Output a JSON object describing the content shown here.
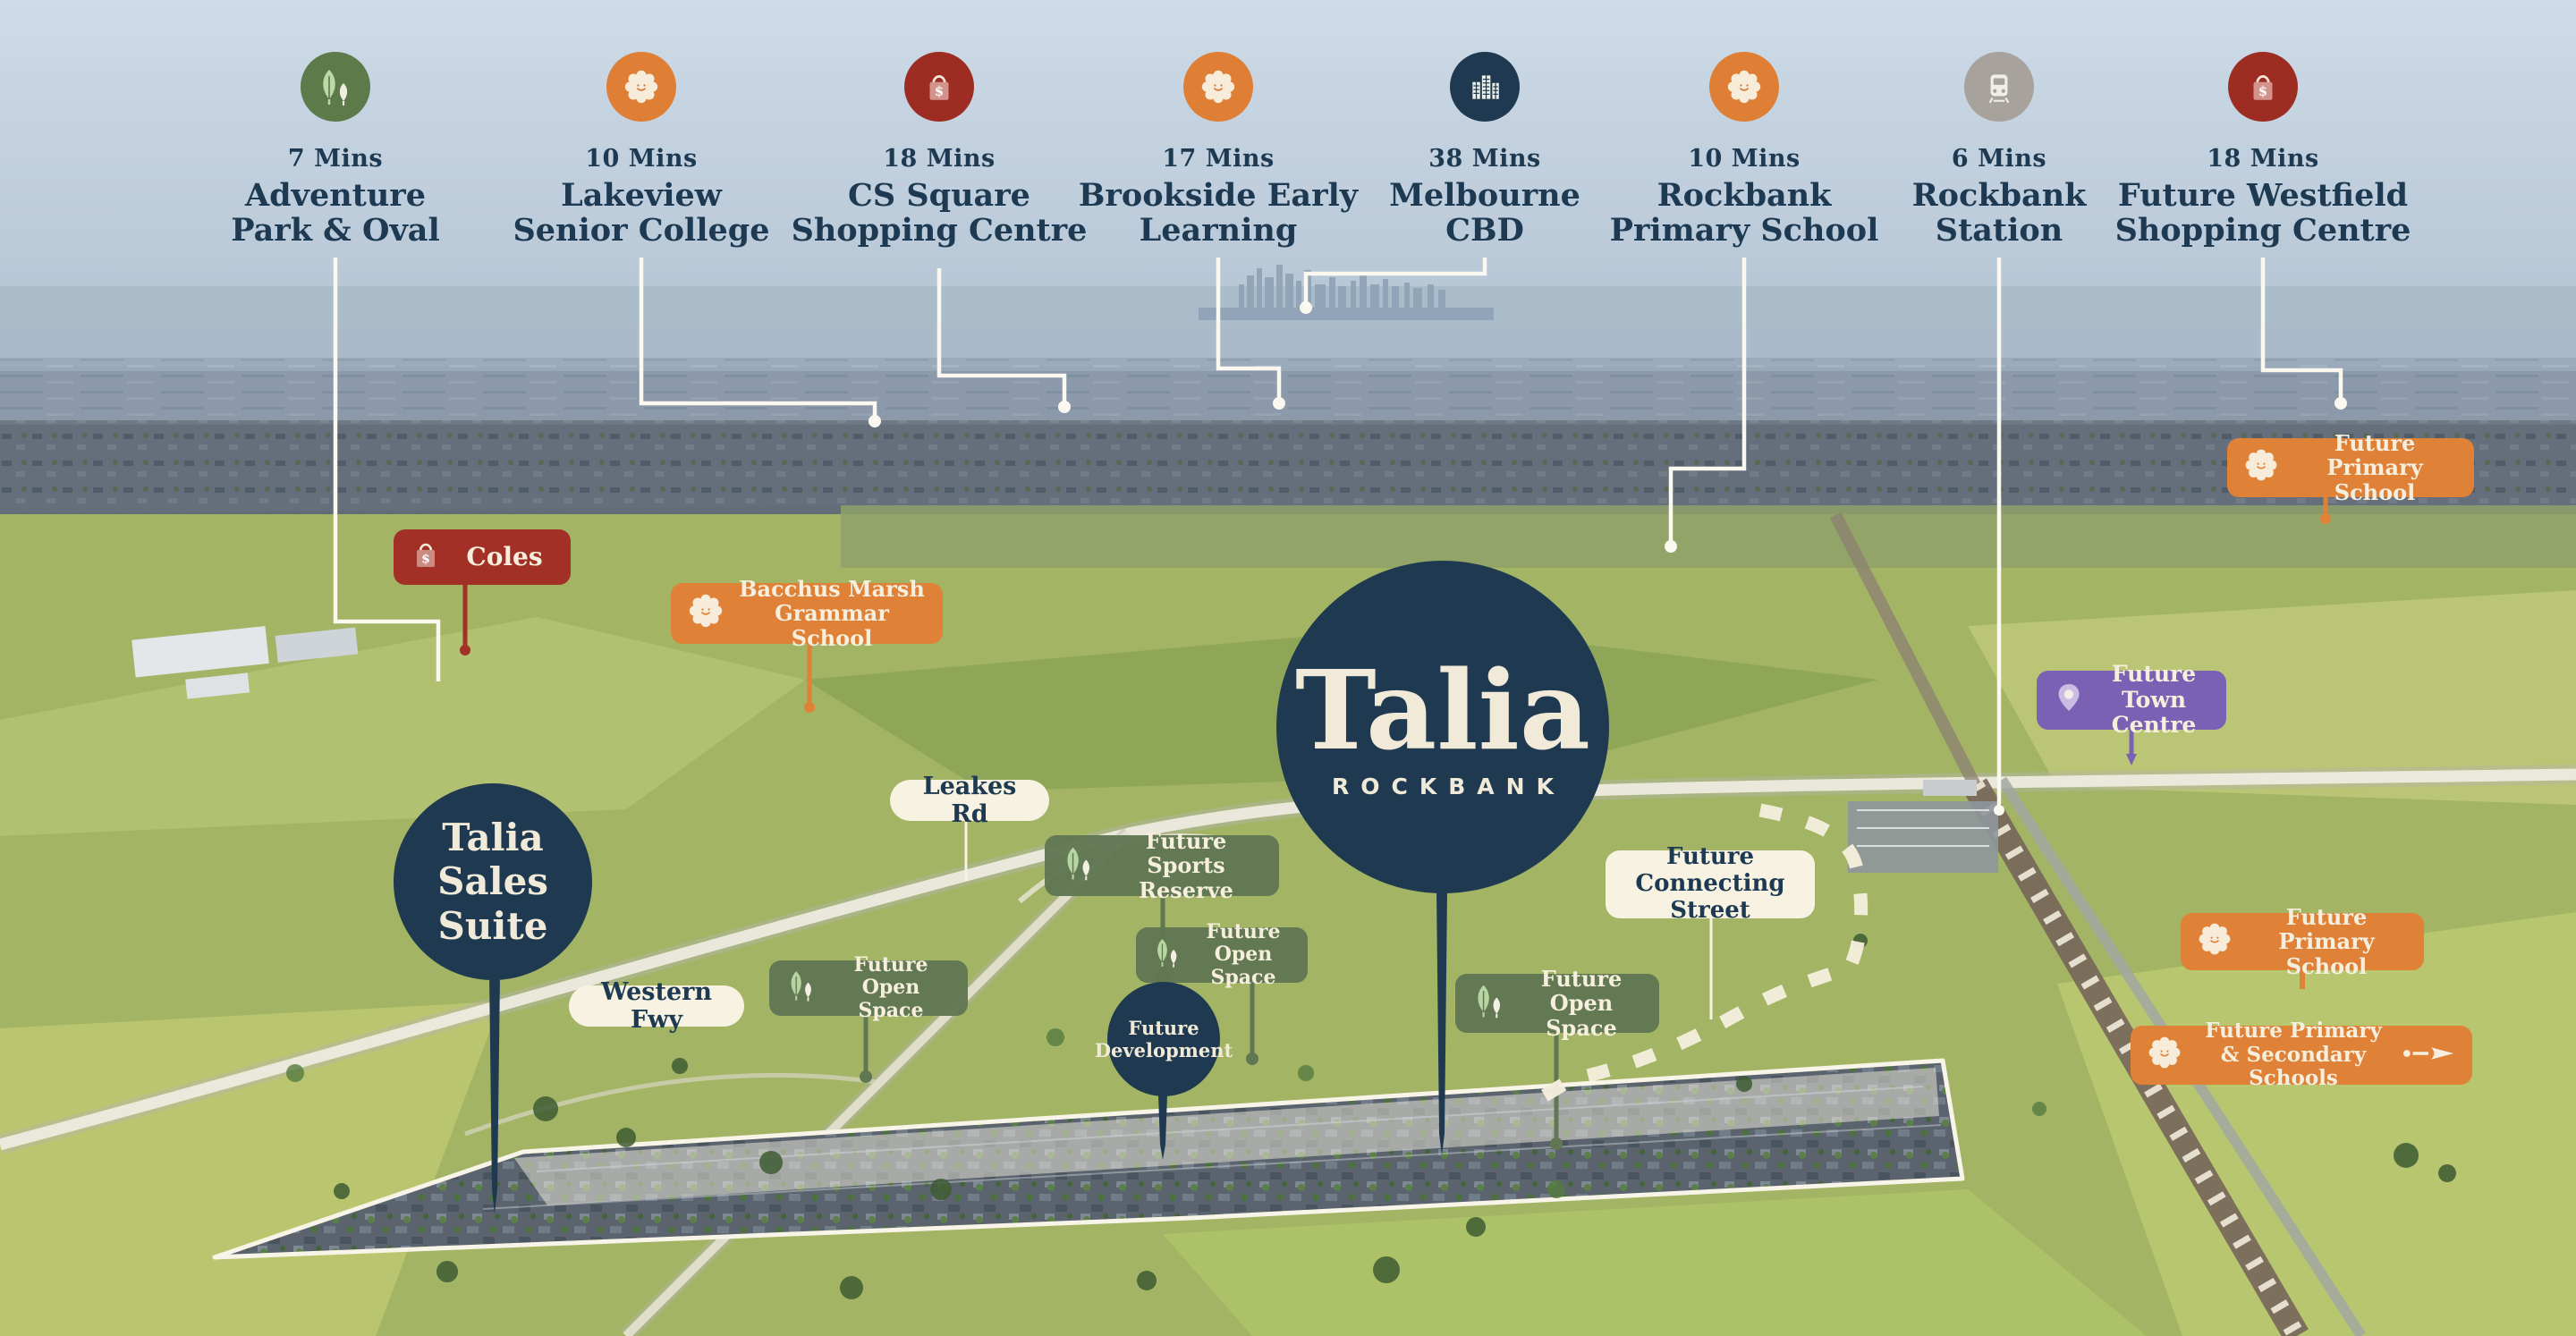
{
  "brand": {
    "wordmark": "Talia",
    "subtitle": "ROCKBANK"
  },
  "colors": {
    "navy": "#1f3a50",
    "orange": "#e08138",
    "dark_red": "#9d2c23",
    "green": "#617753",
    "purple": "#7b61b3",
    "cream": "#f7f2e1",
    "connector_line": "#fbf8ef",
    "text_navy": "#1d3a52"
  },
  "top_row": [
    {
      "minutes": "7 Mins",
      "line1": "Adventure",
      "line2": "Park & Oval",
      "icon": "trees-icon"
    },
    {
      "minutes": "10 Mins",
      "line1": "Lakeview",
      "line2": "Senior College",
      "icon": "flower-icon"
    },
    {
      "minutes": "18 Mins",
      "line1": "CS Square",
      "line2": "Shopping Centre",
      "icon": "shopping-bag-icon"
    },
    {
      "minutes": "17 Mins",
      "line1": "Brookside Early",
      "line2": "Learning",
      "icon": "flower-icon"
    },
    {
      "minutes": "38 Mins",
      "line1": "Melbourne",
      "line2": "CBD",
      "icon": "city-buildings-icon"
    },
    {
      "minutes": "10 Mins",
      "line1": "Rockbank",
      "line2": "Primary School",
      "icon": "flower-icon"
    },
    {
      "minutes": "6 Mins",
      "line1": "Rockbank",
      "line2": "Station",
      "icon": "train-icon"
    },
    {
      "minutes": "18 Mins",
      "line1": "Future Westfield",
      "line2": "Shopping Centre",
      "icon": "shopping-bag-icon"
    }
  ],
  "map_badges": {
    "coles": {
      "label": "Coles"
    },
    "bacchus": {
      "line1": "Bacchus Marsh",
      "line2": "Grammar School"
    },
    "leakes_rd": {
      "label": "Leakes Rd"
    },
    "western_fwy": {
      "label": "Western Fwy"
    },
    "sports_reserve": {
      "line1": "Future",
      "line2": "Sports Reserve"
    },
    "open_space_left": {
      "line1": "Future",
      "line2": "Open Space"
    },
    "open_space_mid": {
      "line1": "Future",
      "line2": "Open Space"
    },
    "open_space_right": {
      "line1": "Future",
      "line2": "Open Space"
    },
    "connecting_street": {
      "line1": "Future",
      "line2": "Connecting Street"
    },
    "town_centre": {
      "line1": "Future",
      "line2": "Town Centre"
    },
    "primary_school_top": {
      "line1": "Future Primary",
      "line2": "School"
    },
    "primary_school_right": {
      "line1": "Future Primary",
      "line2": "School"
    },
    "primary_secondary_schools": {
      "line1": "Future Primary",
      "line2": "& Secondary Schools"
    },
    "future_development": {
      "line1": "Future",
      "line2": "Development"
    },
    "sales_suite": {
      "line1": "Talia",
      "line2": "Sales Suite"
    }
  }
}
